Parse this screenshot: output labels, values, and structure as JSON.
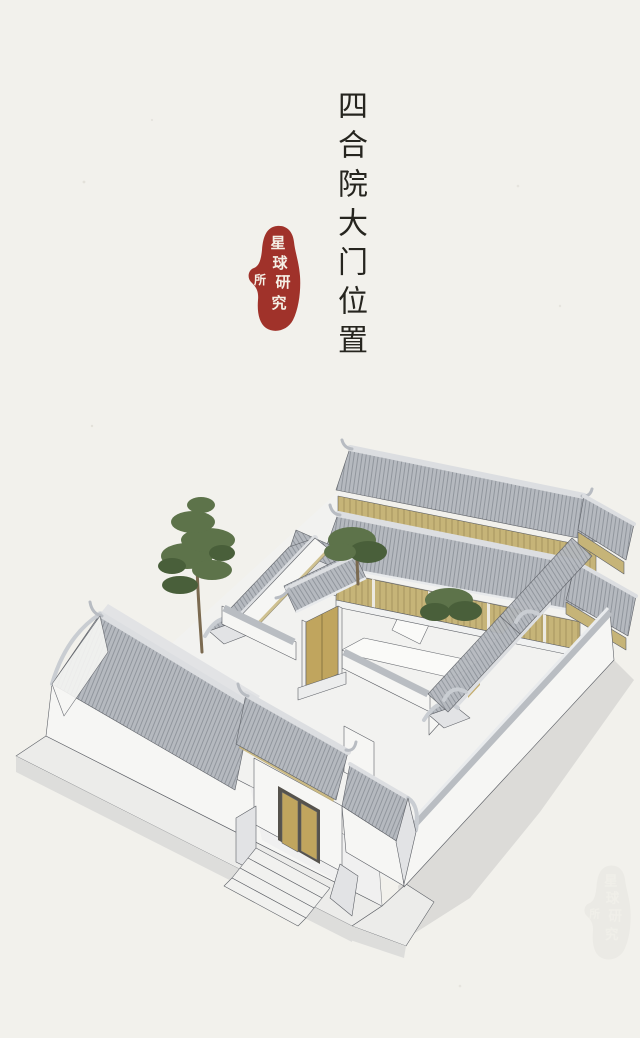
{
  "page": {
    "width": 640,
    "height": 1034
  },
  "title": {
    "text": "四合院大门位置"
  },
  "seal": {
    "name": "星球研究所",
    "chars": [
      "星",
      "球",
      "研",
      "究",
      "所"
    ]
  },
  "watermark": {
    "text": "星球研究所"
  },
  "colors": {
    "paper": "#f2f1ec",
    "ink": "#26251f",
    "seal-red": "#a0322a",
    "seal-text": "#f5f0e6",
    "roof": "#b5b9bf",
    "roof-line": "#8d9299",
    "roof-light": "#c7cbd0",
    "ridge": "#dcdee1",
    "wall": "#f6f6f4",
    "wall-shade": "#e2e3e5",
    "wood": "#c6b478",
    "wood-dark": "#94824f",
    "door-gold": "#c0a55e",
    "tree": "#5d734a",
    "tree-dark": "#495f3a",
    "trunk": "#7b6a50",
    "ground": "#f2f2f0",
    "slab": "#ececea",
    "shadow": "#d6d6d3",
    "outline": "#5e6167"
  }
}
